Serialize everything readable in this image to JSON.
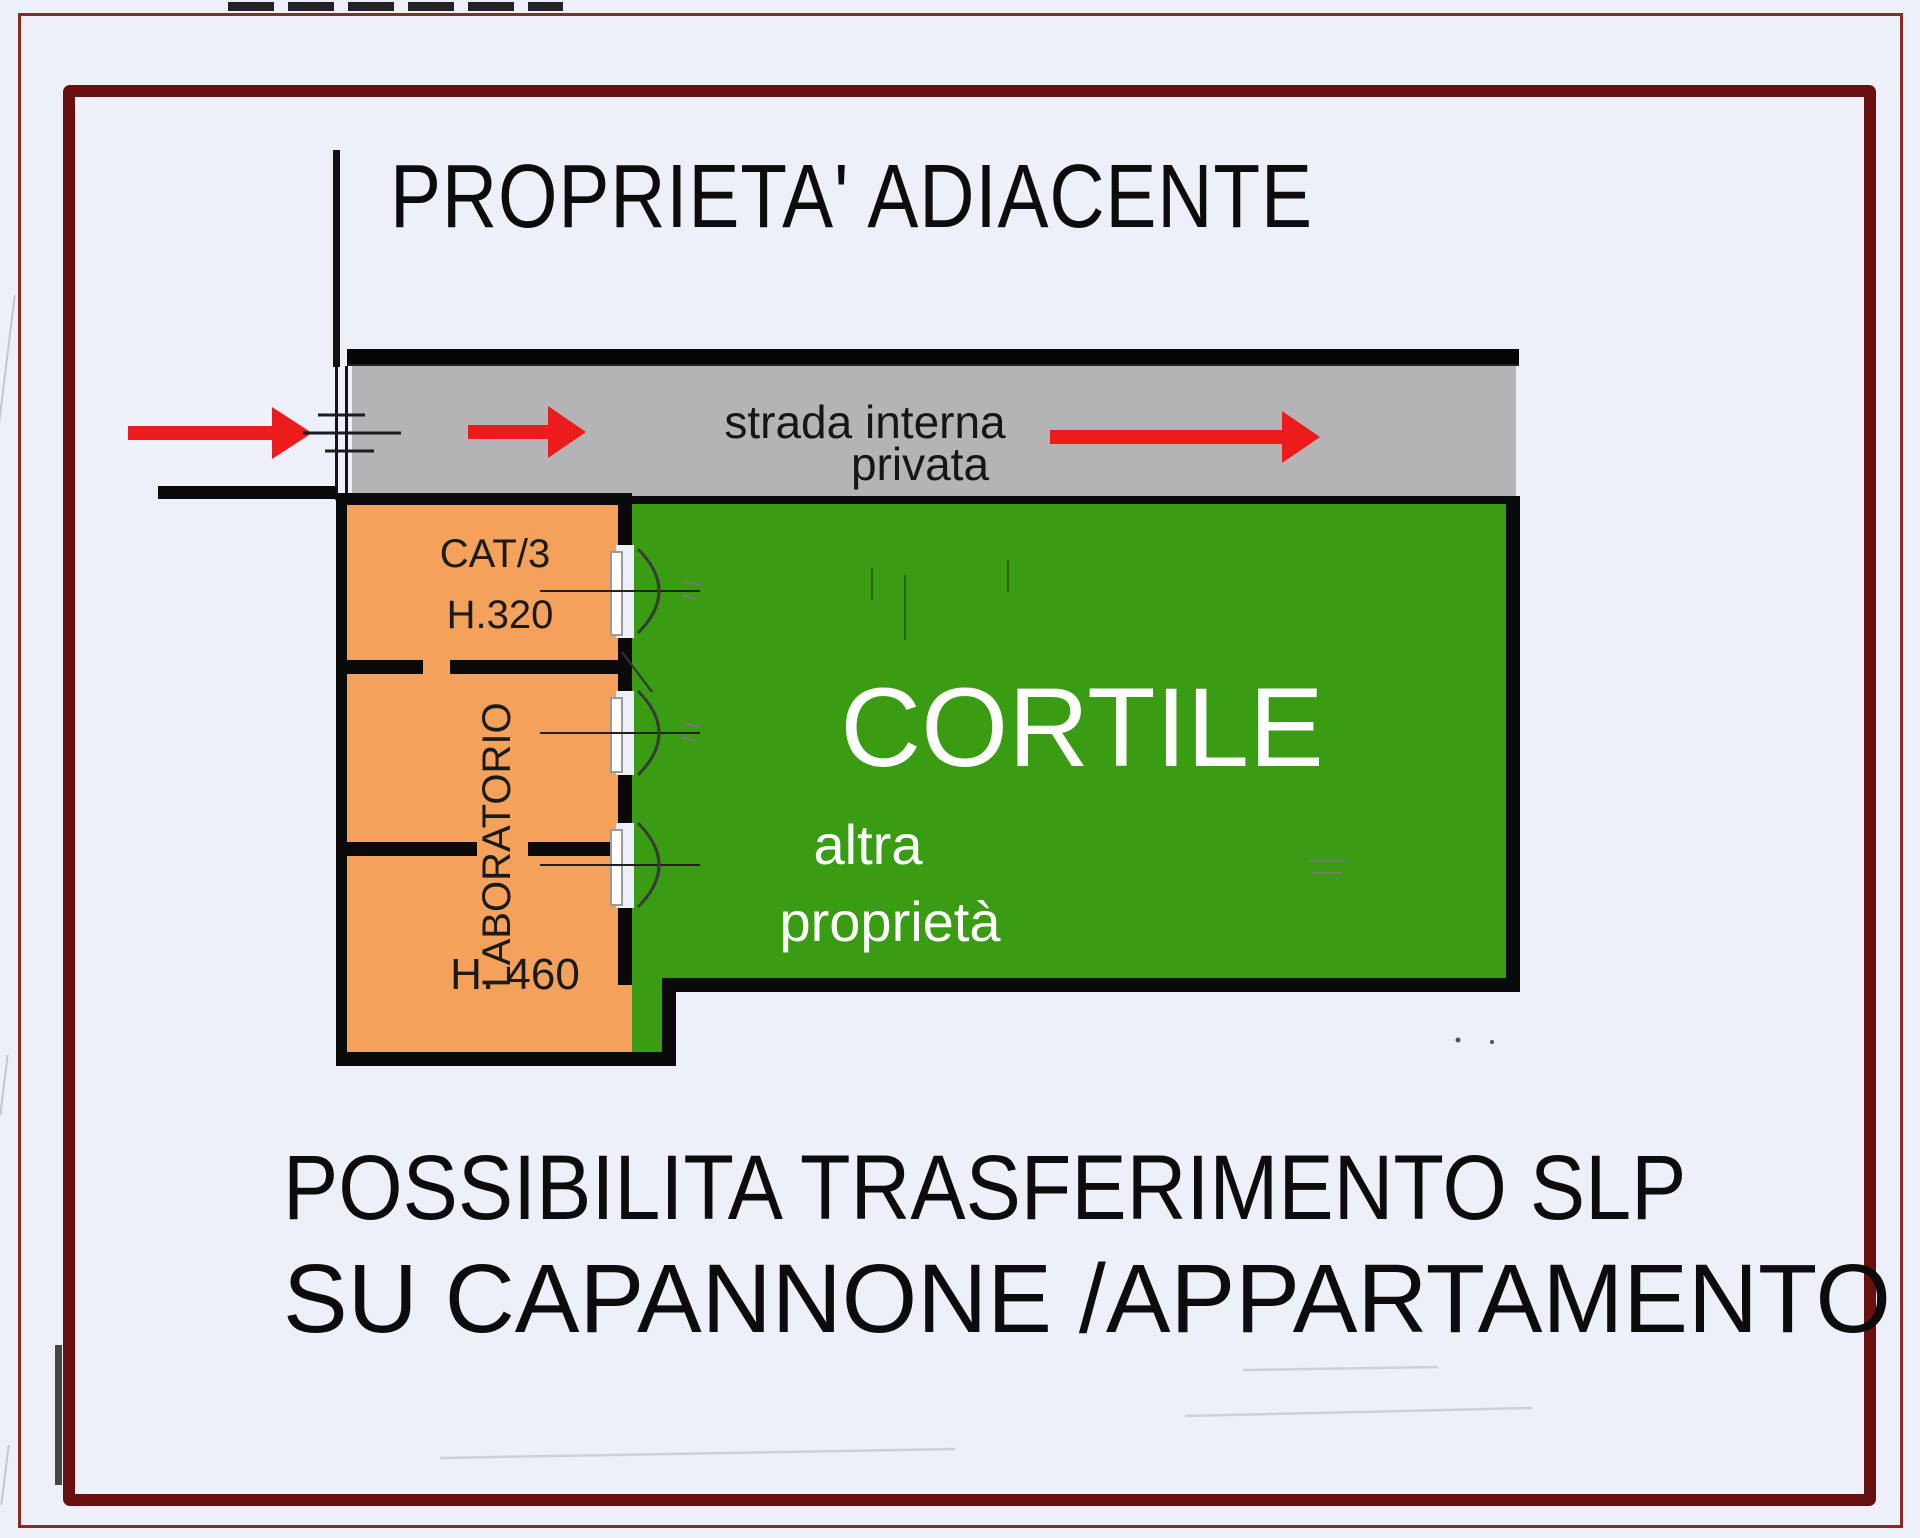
{
  "title": "PROPRIETA' ADIACENTE",
  "road": {
    "name_line1": "strada interna",
    "name_line2": "privata"
  },
  "plan": {
    "workshop": {
      "category": "CAT/3",
      "height_top": "H.320",
      "room": "LABORATORIO",
      "height_bottom": "H. 460"
    },
    "courtyard": {
      "name": "CORTILE",
      "owner_line1": "altra",
      "owner_line2": "proprietà"
    }
  },
  "footer": {
    "line1": "POSSIBILITA TRASFERIMENTO SLP",
    "line2": "SU CAPANNONE /APPARTAMENTO"
  },
  "colors": {
    "page_bg": "#edf0f8",
    "frame_maroon": "#681010",
    "frame_thin": "#8e2826",
    "road_gray": "#b4b4b6",
    "workshop_orange": "#f3a15b",
    "courtyard_green": "#3a9c12",
    "arrow_red": "#ec1c1c",
    "wall_black": "#0a0a0a",
    "label_dark": "#1a1a1a",
    "courtyard_text": "#ffffff"
  }
}
